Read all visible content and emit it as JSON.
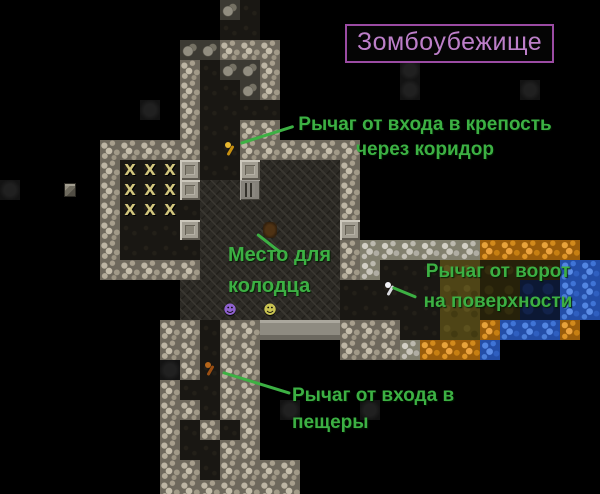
{
  "title": {
    "text": "Зомбоубежище"
  },
  "annotations": [
    {
      "id": "fortress-entrance-lever",
      "lines": [
        "Рычаг от входа в крепость",
        "через коридор"
      ]
    },
    {
      "id": "well-spot",
      "lines": [
        "Место для",
        "колодца"
      ]
    },
    {
      "id": "surface-gate-lever",
      "lines": [
        "Рычаг от ворот",
        "на поверхности"
      ]
    },
    {
      "id": "cave-entrance-lever",
      "lines": [
        "Рычаг от входа в",
        "пещеры"
      ]
    }
  ],
  "colors": {
    "annotation_green": "#3cb043",
    "title_text": "#bd7fc9",
    "title_border": "#9b4ba3",
    "water_blue": "#234ea8",
    "sand_orange": "#9a5d0a",
    "lever_gold": "#e8b830",
    "lever_white": "#f2f2f6",
    "lever_rust": "#b5651a"
  },
  "map": {
    "tile_size": 20,
    "cols": 30,
    "rows_count": 25,
    "palette": {
      ".": {
        "name": "unexplored-tile",
        "cls": "t-empty",
        "glyph": "",
        "interactable": false
      },
      "C": {
        "name": "cobblestone-wall-tile",
        "cls": "t-C",
        "glyph": "",
        "interactable": true
      },
      "G": {
        "name": "rough-stone-wall-tile",
        "cls": "t-G",
        "glyph": "",
        "interactable": true
      },
      "M": {
        "name": "smooth-wall-tile",
        "cls": "t-M",
        "glyph": "",
        "interactable": true
      },
      "E": {
        "name": "engraved-floor-tile",
        "cls": "t-E",
        "glyph": "",
        "interactable": true
      },
      "D": {
        "name": "dark-floor-tile",
        "cls": "t-D",
        "glyph": "",
        "interactable": true
      },
      "X": {
        "name": "stockpile-x-tile",
        "cls": "t-D t-X",
        "glyph": "X",
        "interactable": true
      },
      "B": {
        "name": "boulder-tile",
        "cls": "t-B",
        "glyph": "",
        "interactable": true
      },
      "P": {
        "name": "pillar-tile",
        "cls": "t-P",
        "glyph": "",
        "interactable": true
      },
      "S": {
        "name": "statue-tile",
        "cls": "t-S",
        "glyph": "",
        "interactable": true
      },
      "O": {
        "name": "sand-tile",
        "cls": "t-O",
        "glyph": "",
        "interactable": true
      },
      "W": {
        "name": "water-tile",
        "cls": "t-W",
        "glyph": "",
        "interactable": true
      },
      "w": {
        "name": "deep-water-tile",
        "cls": "t-w",
        "glyph": "",
        "interactable": true
      },
      "Y": {
        "name": "dirt-floor-tile",
        "cls": "t-Y",
        "glyph": "",
        "interactable": true
      },
      "y": {
        "name": "dark-dirt-tile",
        "cls": "t-y",
        "glyph": "",
        "interactable": true
      },
      "f": {
        "name": "faint-rubble-tile",
        "cls": "t-f",
        "glyph": "",
        "interactable": true
      },
      "b": {
        "name": "well-spot-tile",
        "cls": "t-E t-well",
        "glyph": "",
        "interactable": true
      },
      "1": {
        "name": "lever-fortress-entrance",
        "cls": "t-D t-lever t-lever-gold",
        "glyph": "",
        "interactable": true
      },
      "2": {
        "name": "lever-surface-gate",
        "cls": "t-D t-lever t-lever-white",
        "glyph": "",
        "interactable": true
      },
      "3": {
        "name": "lever-cave-entrance",
        "cls": "t-D t-lever t-lever-rust",
        "glyph": "",
        "interactable": true
      },
      "u": {
        "name": "dwarf-purple",
        "cls": "t-E t-dwarf t-dwarf-purple",
        "glyph": "☻",
        "interactable": true
      },
      "v": {
        "name": "dwarf-yellow",
        "cls": "t-E t-dwarf t-dwarf-yellow",
        "glyph": "☻",
        "interactable": true
      },
      "K": {
        "name": "crate-item",
        "cls": "t-empty t-K",
        "glyph": "",
        "interactable": true
      }
    },
    "rows": [
      "...........BD.................",
      "...........DD.................",
      ".........BBCCC................",
      ".........CDBBC......f.........",
      ".........CDDBC......f.....f...",
      ".......f.CDDDD................",
      ".........CDDCC................",
      ".....CCCCCD1CCCCCC............",
      ".....CXXXPDDPEEEEC............",
      "f..K.CXXXPEESEEEEC............",
      ".....CXXXDEEEEEEEC............",
      ".....CDDDPEEEbEEEP............",
      ".....CDDDDEEEEEEECGGGGGGOOOOO.",
      ".....CCCCCEEEEEEECGDDDYYyyyyWW",
      ".........EEEEEEEEDD2DDYYyywwWW",
      ".........EEuEvEEEDDDDDYYyywwWW",
      "........CCDCCMMMMCCCDDYYOWWWO.",
      "........CCDCC....CCCGOOOW.....",
      "........fC3CC.................",
      "........CDDCC.................",
      "........CCDCC.f...f...........",
      "........CDCDC.................",
      "........CDDCC.................",
      "........CCDCCCC...............",
      "........CCCCCCC..............."
    ]
  }
}
